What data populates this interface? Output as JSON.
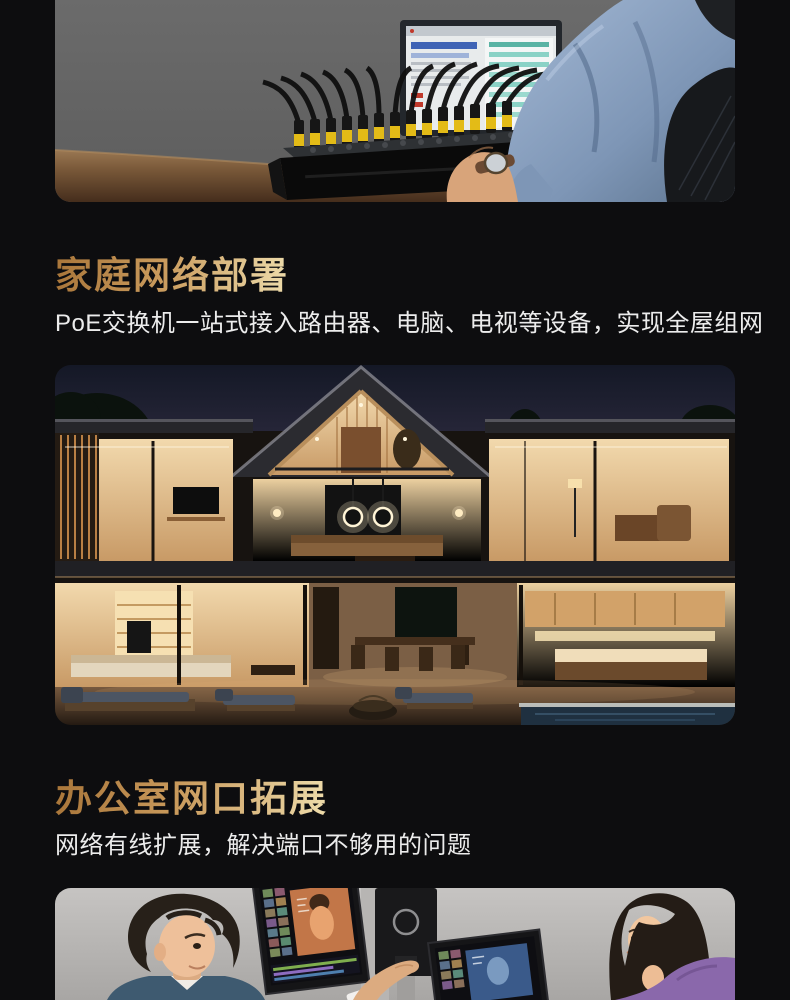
{
  "page": {
    "background_color": "#0d0d0f",
    "title_gradient_start": "#a9763a",
    "title_gradient_end": "#eedcab",
    "subtitle_color": "#ececec"
  },
  "hero_section": {
    "image_name": "person-at-desk-using-poe-switch-photo"
  },
  "home_section": {
    "title": "家庭网络部署",
    "subtitle": "PoE交换机一站式接入路由器、电脑、电视等设备，实现全屋组网",
    "image_name": "smart-home-at-dusk-photo"
  },
  "office_section": {
    "title": "办公室网口拓展",
    "subtitle": "网络有线扩展，解决端口不够用的问题",
    "image_name": "office-dual-monitors-photo"
  }
}
